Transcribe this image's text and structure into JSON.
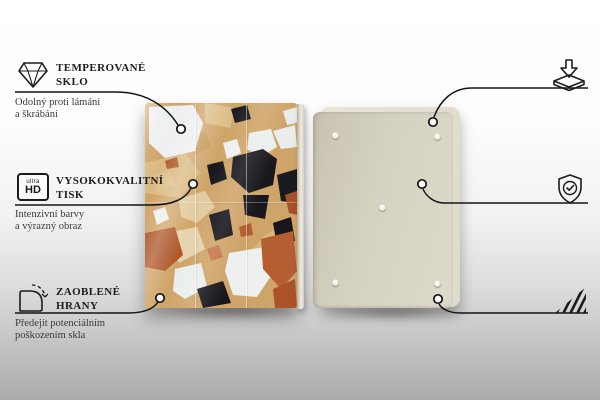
{
  "product_views": {
    "front": "glass board with terrazzo pattern",
    "back": "cream back panel with five anti-slip pads"
  },
  "colors": {
    "text": "#1c1c1c",
    "line": "#141414",
    "terrazzo_base": "#cfa468",
    "terrazzo_black": "#17171d",
    "terrazzo_white": "#edeff0",
    "terrazzo_rust": "#ad5528",
    "terrazzo_cream": "#e2cba0",
    "back_panel": "#d6d2c2"
  },
  "features_left": [
    {
      "icon": "diamond-icon",
      "title_lines": [
        "TEMPEROVANÉ",
        "SKLO"
      ],
      "desc_lines": [
        "Odolný proti lámání",
        "a škrábání"
      ]
    },
    {
      "icon": "ultra-hd-icon",
      "icon_text": {
        "top": "ultra",
        "bottom": "HD"
      },
      "title_lines": [
        "VYSOKOKVALITNÍ",
        "TISK"
      ],
      "desc_lines": [
        "Intenzivní barvy",
        "a výrazný obraz"
      ]
    },
    {
      "icon": "rounded-corner-icon",
      "title_lines": [
        "ZAOBLENÉ",
        "HRANY"
      ],
      "desc_lines": [
        "Předejít potenciálním",
        "poškozením skla"
      ]
    }
  ],
  "features_right": [
    {
      "icon": "anti-slip-pads-icon",
      "title_lines": [
        "PROTISKLUZOVÉ",
        "PODLOŽKY"
      ],
      "desc_lines": [
        "Samolepící gumové",
        "podložky jsou",
        "součástí balení"
      ]
    },
    {
      "icon": "shield-check-icon",
      "title_lines": [
        "OCHRANNÁ",
        "FÓLIE"
      ],
      "desc_lines": [
        "Chrání zadní",
        "část výrobku"
      ]
    },
    {
      "icon": "polished-edges-icon",
      "title_lines": [
        "LEŠTĚNÉ",
        "HRANY"
      ],
      "desc_lines": [
        "Hladký a bezpečný povrch"
      ]
    }
  ]
}
